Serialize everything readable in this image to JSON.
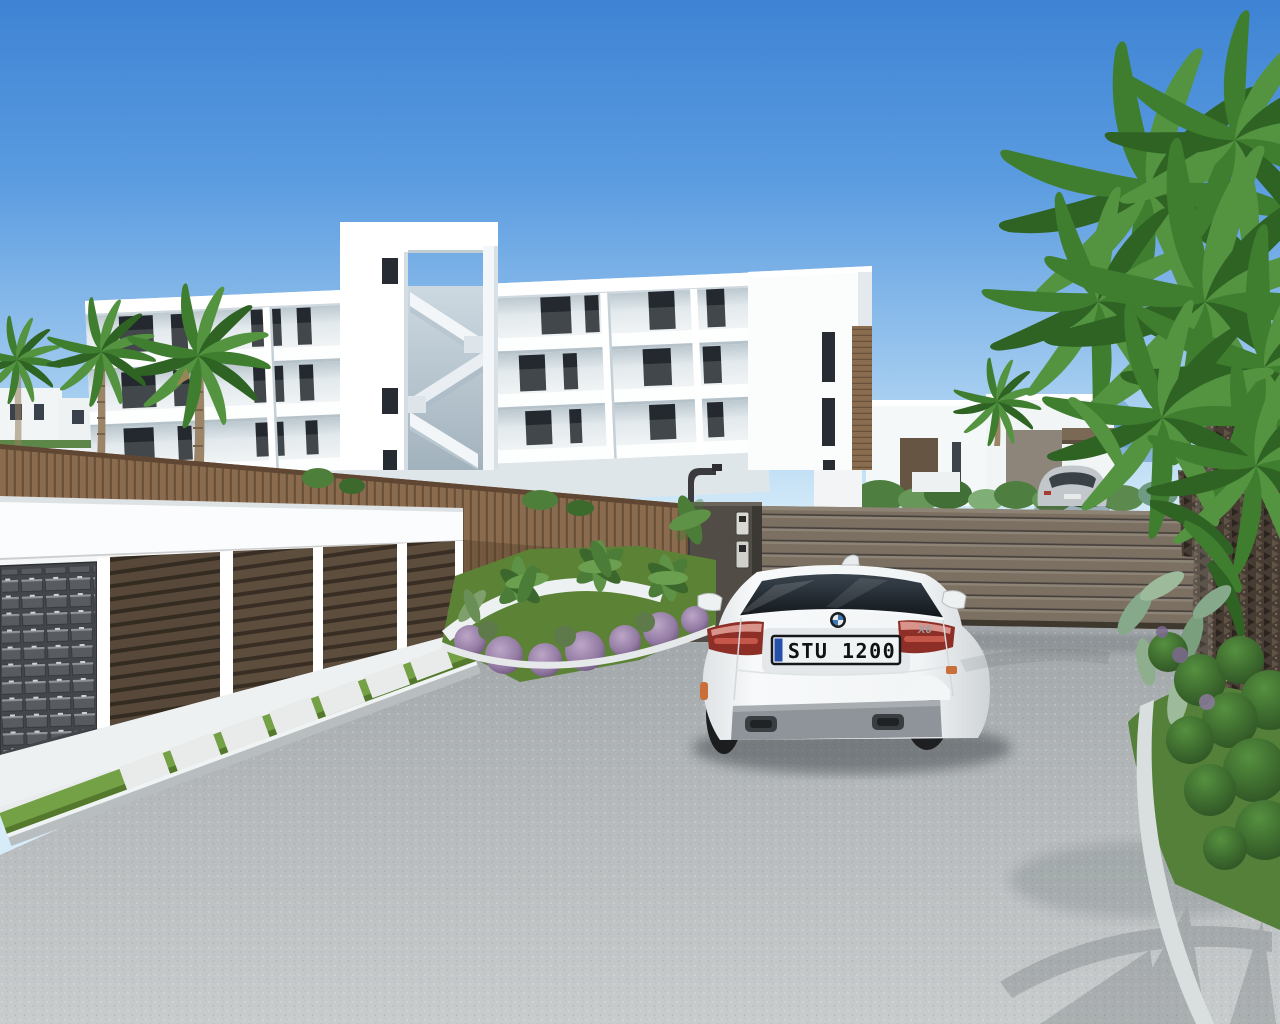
{
  "scene": {
    "setting": "3D exterior rendering of a new-build residential complex with driveway",
    "objects": [
      "white three-storey apartment building with balconies",
      "open stair tower with zigzag staircase",
      "palm trees",
      "wooden privacy fence",
      "brown slatted sliding gate",
      "gate pillar with two intercom panels",
      "curved street lamp",
      "garage block with slatted doors",
      "mailbox bank",
      "white BMW X6 seen from rear",
      "background villas with cacti garden",
      "distant blue mountains",
      "silver coupe parked beyond gate",
      "planting bed with banana plants and purple shrubs",
      "gravel driveway with paver walkway"
    ]
  },
  "car": {
    "brand": "BMW",
    "license_plate": "STU 1200",
    "model_badge": "X6",
    "color": "white"
  },
  "palette": {
    "sky_top": "#3e83d4",
    "sky_horizon": "#d6ecf9",
    "building_white": "#fafcfd",
    "window_dark": "#23292e",
    "fence_brown": "#8b6b4d",
    "gate_brown": "#7b7060",
    "garage_door_brown": "#5d4d3d",
    "mailbox_grey": "#43464a",
    "asphalt_grey": "#b3b8ba",
    "grass_green": "#6d9040",
    "palm_green": "#3f7d2f",
    "mountain_blue": "#69a0cc",
    "car_white": "#f7f9fa",
    "taillight_red": "#8e2f27",
    "plate_blue_band": "#2750a8"
  }
}
